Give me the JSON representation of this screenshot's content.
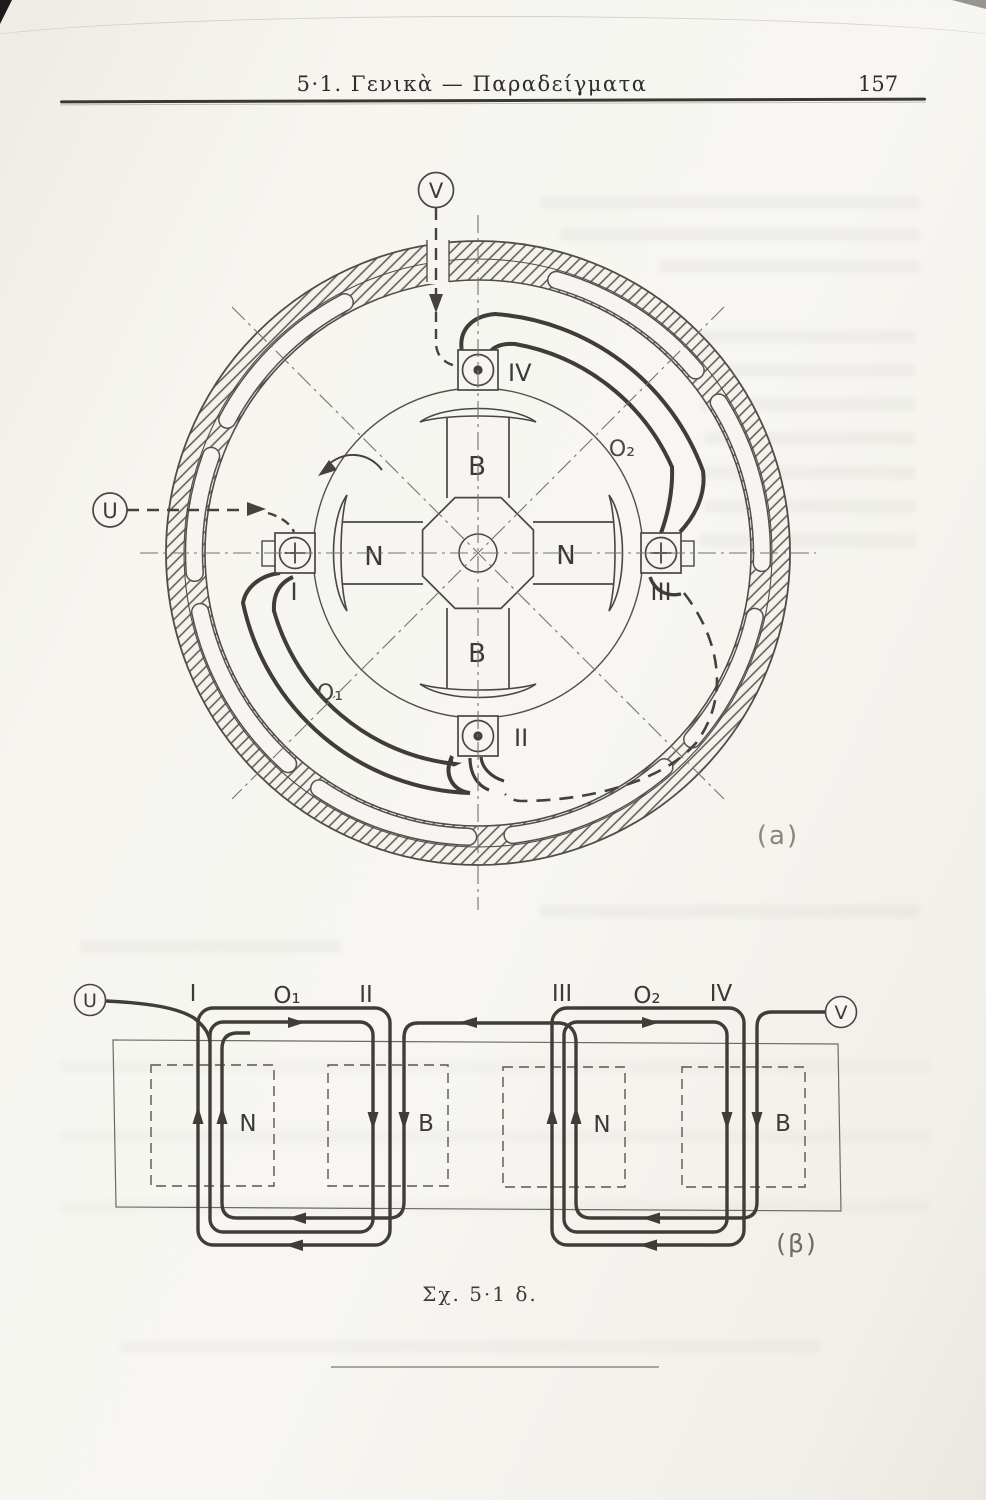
{
  "header": {
    "title": "5·1. Γενικὰ — Παραδείγματα",
    "page_number": "157"
  },
  "figure_a": {
    "label": "(a)",
    "terminal_left": "U",
    "terminal_top": "V",
    "coil_labels": {
      "left": "I",
      "bottom": "II",
      "right": "III",
      "top": "IV"
    },
    "pole_labels": {
      "top": "B",
      "bottom": "B",
      "left": "N",
      "right": "N"
    },
    "connection_label_1": "O₁",
    "connection_label_2": "O₂"
  },
  "figure_b": {
    "label": "(β)",
    "terminal_left": "U",
    "terminal_right": "V",
    "coil_labels": [
      "I",
      "O₁",
      "II",
      "III",
      "O₂",
      "IV"
    ],
    "pole_labels": [
      "N",
      "B",
      "N",
      "B"
    ]
  },
  "caption": "Σχ. 5·1 δ."
}
